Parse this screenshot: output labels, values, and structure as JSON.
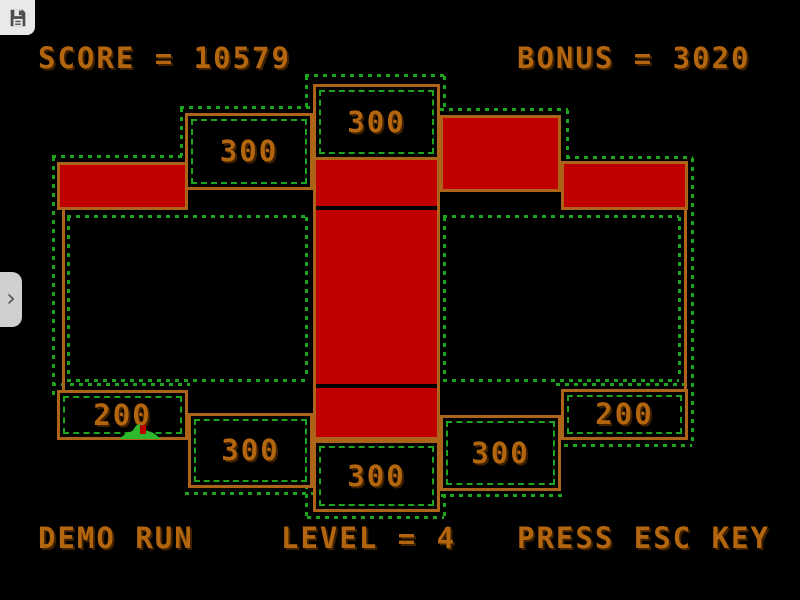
{
  "hud": {
    "score_text": "SCORE = 10579",
    "bonus_text": "BONUS = 3020",
    "demo_text": "DEMO RUN",
    "level_text": "LEVEL = 4",
    "esc_text": "PRESS ESC KEY"
  },
  "board": {
    "labels": {
      "top_center": "300",
      "upper_left": "300",
      "bottom_left": "200",
      "bottom_mid_left": "300",
      "bottom_center": "300",
      "bottom_mid_right": "300",
      "bottom_right": "200"
    }
  },
  "chrome": {
    "save_icon": "floppy-disk",
    "drawer_chevron": "›"
  },
  "colors": {
    "bg": "#000000",
    "wall": "#ad6418",
    "text": "#b4660e",
    "red-fill": "#c00000",
    "dot-green": "#1fa41f",
    "creature": "#2db82d",
    "chrome-bg": "#e9e9e9",
    "tab-bg": "#d0d0d0"
  }
}
